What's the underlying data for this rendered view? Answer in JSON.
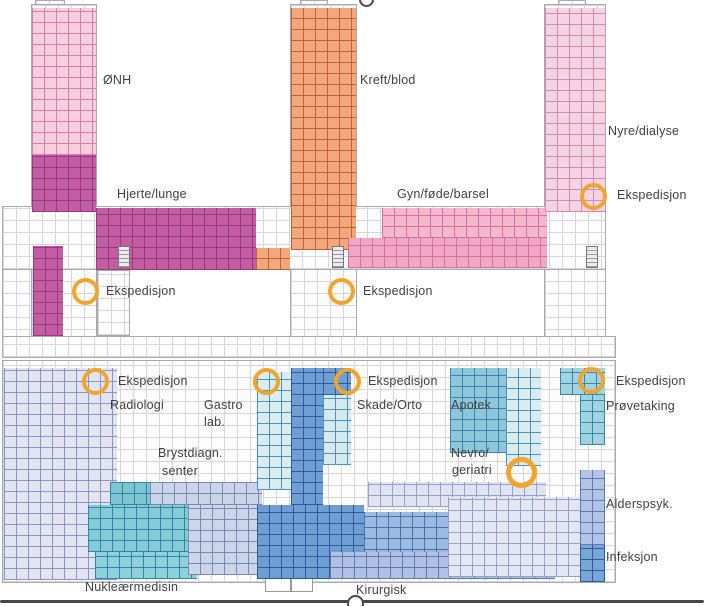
{
  "map_type": "hospital-floor-plan",
  "upper_floor": {
    "departments": [
      {
        "name": "ØNH",
        "color": "#f7cede"
      },
      {
        "name": "Kreft/blod",
        "color": "#f3a77c"
      },
      {
        "name": "Nyre/dialyse",
        "color": "#f5d3e3"
      },
      {
        "name": "Hjerte/lunge",
        "color": "#c25da4"
      },
      {
        "name": "Gyn/føde/barsel",
        "color": "#f2a8c4"
      }
    ],
    "expedition_label": "Ekspedisjon"
  },
  "lower_floor": {
    "departments": [
      {
        "name": "Radiologi",
        "color": "#e2e4f2"
      },
      {
        "name": "Gastro lab.",
        "line1": "Gastro",
        "line2": "lab.",
        "color": "#d9ecef"
      },
      {
        "name": "Skade/Orto",
        "color": "#6f9ed2"
      },
      {
        "name": "Apotek",
        "color": "#d9edf0"
      },
      {
        "name": "Prøvetaking",
        "color": "#9fd3e0"
      },
      {
        "name": "Brystdiagn. senter",
        "line1": "Brystdiagn.",
        "line2": "senter",
        "color": "#ccd4e9"
      },
      {
        "name": "Nevro/geriatri",
        "line1": "Nevro/",
        "line2": "geriatri",
        "color": "#e3e6f3"
      },
      {
        "name": "Alderspsyk.",
        "color": "#b2c4e5"
      },
      {
        "name": "Infeksjon",
        "color": "#78a6d8"
      },
      {
        "name": "Nukleærmedisin",
        "color": "#8fd0dc"
      },
      {
        "name": "Kirurgisk",
        "color": "#b0c1e4"
      }
    ],
    "expedition_label": "Ekspedisjon"
  },
  "marker": {
    "label": "Ekspedisjon",
    "color": "#f2a52e",
    "count_visible": 8
  }
}
